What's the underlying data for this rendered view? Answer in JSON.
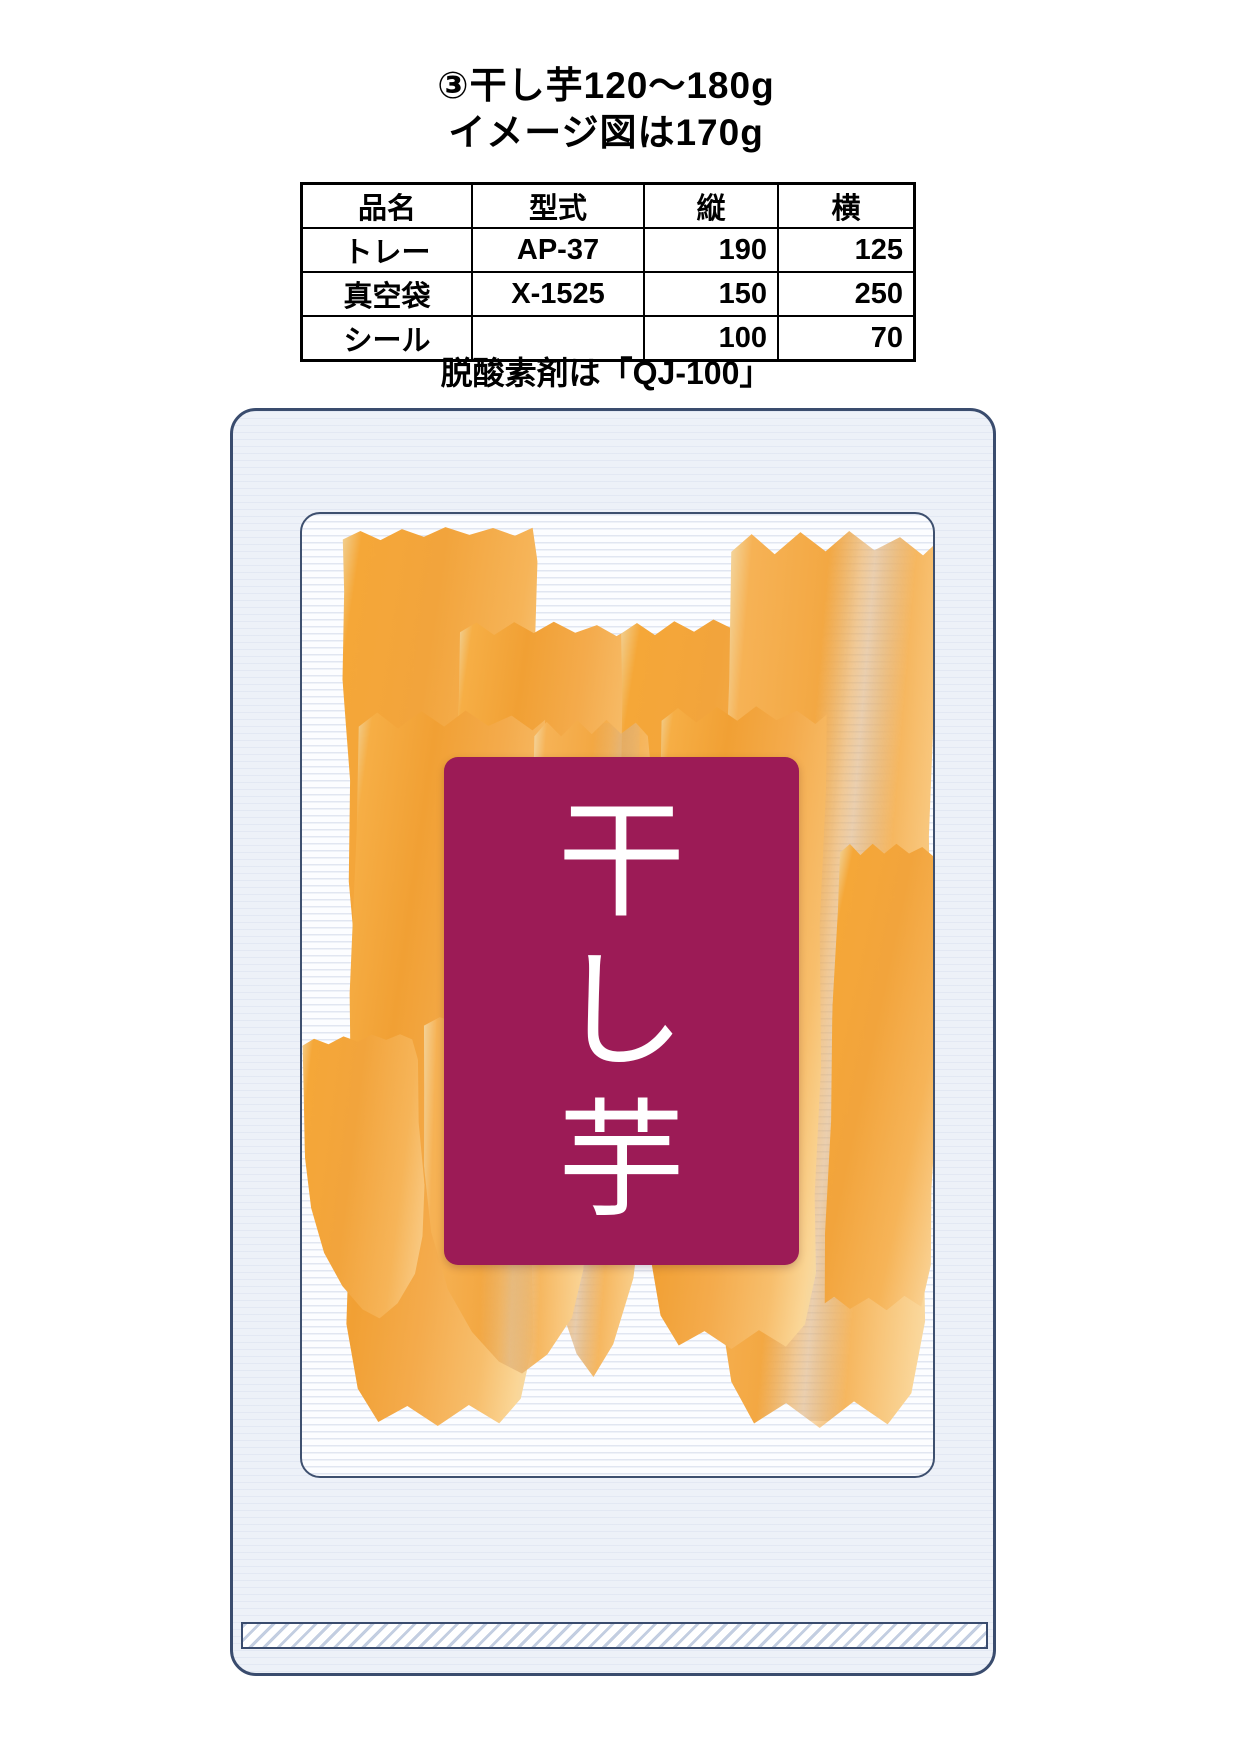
{
  "header": {
    "title_line1": "③干し芋120〜180g",
    "title_line2": "イメージ図は170g"
  },
  "spec_table": {
    "headers": [
      "品名",
      "型式",
      "縦",
      "横"
    ],
    "rows": [
      [
        "トレー",
        "AP-37",
        "190",
        "125"
      ],
      [
        "真空袋",
        "X-1525",
        "150",
        "250"
      ],
      [
        "シール",
        "",
        "100",
        "70"
      ]
    ]
  },
  "note": {
    "text": "脱酸素剤は「QJ-100」"
  },
  "package": {
    "label_char_1": "干",
    "label_char_2": "し",
    "label_char_3": "芋",
    "label_text": "干し芋"
  },
  "colors": {
    "label_background": "#9C1B56",
    "label_text": "#FFFFFF",
    "package_outline": "#3A4C6E",
    "bag_fill": "#EDF1F8",
    "slice_orange": "#F3A53E"
  }
}
